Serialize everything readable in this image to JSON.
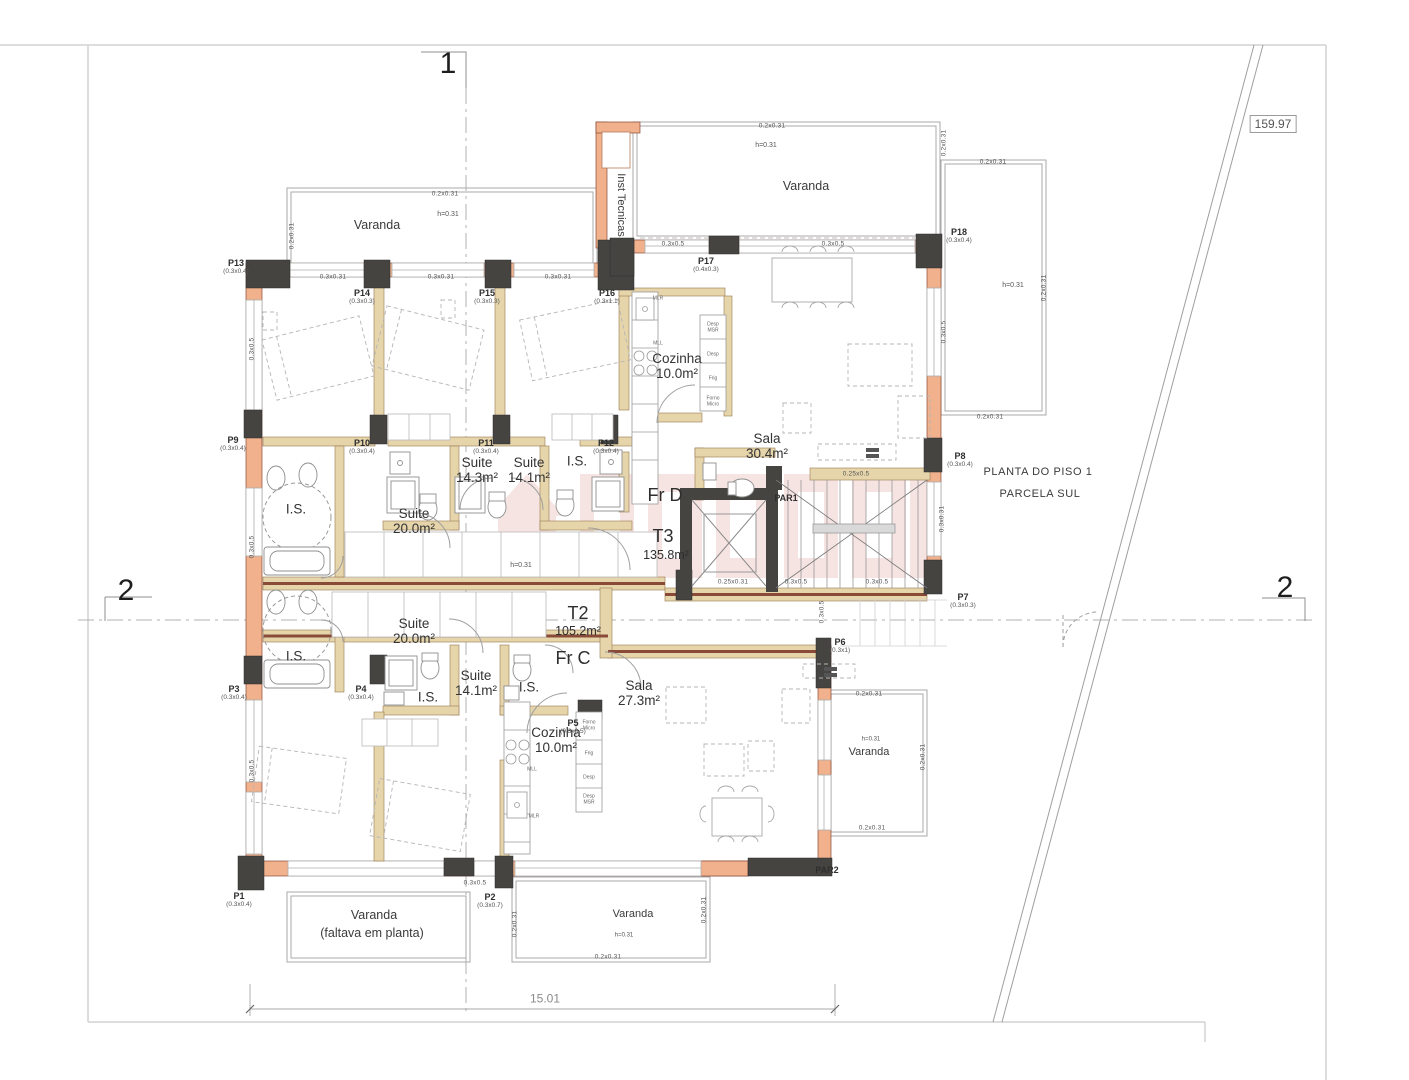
{
  "plan": {
    "colors": {
      "wall_exterior": "#f0b18c",
      "wall_interior": "#e6d5ab",
      "wall_stripe": "#8a4a38",
      "column_dark": "#454441",
      "line_gray": "#9a9a9a",
      "text": "#3b3b3b",
      "watermark": "#c44a3c"
    },
    "survey": {
      "value": "159.97",
      "x": 1273,
      "y": 124
    },
    "sections": [
      {
        "t": "1",
        "x": 448,
        "y": 64
      },
      {
        "t": "2",
        "x": 126,
        "y": 591
      },
      {
        "t": "2",
        "x": 1285,
        "y": 588
      }
    ],
    "title": [
      {
        "t": "PLANTA DO PISO 1",
        "x": 1038,
        "y": 472
      },
      {
        "t": "PARCELA SUL",
        "x": 1040,
        "y": 494
      }
    ],
    "areas": [
      {
        "t": "Varanda",
        "x": 377,
        "y": 225
      },
      {
        "t": "Varanda",
        "x": 806,
        "y": 186
      },
      {
        "t": "Inst Tecnicas",
        "x": 621,
        "y": 205,
        "r": 90,
        "s": 11
      },
      {
        "t": "Varanda",
        "x": 869,
        "y": 752,
        "s": 11
      },
      {
        "t": "Varanda",
        "x": 374,
        "y": 915
      },
      {
        "t": "(faltava em planta)",
        "x": 372,
        "y": 933
      },
      {
        "t": "Varanda",
        "x": 633,
        "y": 914,
        "s": 11
      }
    ],
    "rooms": [
      {
        "t": "Suite\n14.3m²",
        "x": 477,
        "y": 470
      },
      {
        "t": "Suite\n14.1m²",
        "x": 529,
        "y": 470
      },
      {
        "t": "I.S.",
        "x": 577,
        "y": 461
      },
      {
        "t": "Suite\n20.0m²",
        "x": 414,
        "y": 521
      },
      {
        "t": "I.S.",
        "x": 296,
        "y": 509
      },
      {
        "t": "Cozinha\n10.0m²",
        "x": 677,
        "y": 366
      },
      {
        "t": "Sala\n30.4m²",
        "x": 767,
        "y": 446
      },
      {
        "t": "Suite\n20.0m²",
        "x": 414,
        "y": 631
      },
      {
        "t": "I.S.",
        "x": 296,
        "y": 656
      },
      {
        "t": "I.S.",
        "x": 428,
        "y": 697
      },
      {
        "t": "Suite\n14.1m²",
        "x": 476,
        "y": 683
      },
      {
        "t": "I.S.",
        "x": 529,
        "y": 687
      },
      {
        "t": "Sala\n27.3m²",
        "x": 639,
        "y": 693
      },
      {
        "t": "Cozinha\n10.0m²",
        "x": 556,
        "y": 740
      }
    ],
    "units": [
      {
        "t": "Fr D",
        "x": 665,
        "y": 495,
        "s": 18
      },
      {
        "t": "T3",
        "x": 663,
        "y": 536,
        "s": 18
      },
      {
        "t": "135.8m²",
        "x": 666,
        "y": 555,
        "s": 12.5
      },
      {
        "t": "T2",
        "x": 578,
        "y": 613,
        "s": 18
      },
      {
        "t": "105.2m²",
        "x": 578,
        "y": 631,
        "s": 12.5
      },
      {
        "t": "Fr C",
        "x": 573,
        "y": 658,
        "s": 18
      }
    ],
    "doors": [
      {
        "id": "P13",
        "dim": "(0.3x0.4)",
        "x": 236,
        "y": 267
      },
      {
        "id": "P14",
        "dim": "(0.3x0.3)",
        "x": 362,
        "y": 297
      },
      {
        "id": "P15",
        "dim": "(0.3x0.3)",
        "x": 487,
        "y": 297
      },
      {
        "id": "P16",
        "dim": "(0.3x1.1)",
        "x": 607,
        "y": 297
      },
      {
        "id": "P17",
        "dim": "(0.4x0.3)",
        "x": 706,
        "y": 265
      },
      {
        "id": "P18",
        "dim": "(0.3x0.4)",
        "x": 959,
        "y": 236
      },
      {
        "id": "P9",
        "dim": "(0.3x0.4)",
        "x": 233,
        "y": 444
      },
      {
        "id": "P10",
        "dim": "(0.3x0.4)",
        "x": 362,
        "y": 447
      },
      {
        "id": "P11",
        "dim": "(0.3x0.4)",
        "x": 486,
        "y": 447
      },
      {
        "id": "P12",
        "dim": "(0.3x0.4)",
        "x": 606,
        "y": 447
      },
      {
        "id": "P8",
        "dim": "(0.3x0.4)",
        "x": 960,
        "y": 460
      },
      {
        "id": "P7",
        "dim": "(0.3x0.3)",
        "x": 963,
        "y": 601
      },
      {
        "id": "P6",
        "dim": "(0.3x1)",
        "x": 840,
        "y": 646
      },
      {
        "id": "P5",
        "dim": "(0.3x0.5)",
        "x": 573,
        "y": 727
      },
      {
        "id": "P4",
        "dim": "(0.3x0.4)",
        "x": 361,
        "y": 693
      },
      {
        "id": "P3",
        "dim": "(0.3x0.4)",
        "x": 234,
        "y": 693
      },
      {
        "id": "P2",
        "dim": "(0.3x0.7)",
        "x": 490,
        "y": 901
      },
      {
        "id": "P1",
        "dim": "(0.3x0.4)",
        "x": 239,
        "y": 900
      },
      {
        "id": "PAR1",
        "dim": "",
        "x": 786,
        "y": 498
      },
      {
        "id": "PAR2",
        "dim": "",
        "x": 827,
        "y": 870
      }
    ],
    "dims": [
      {
        "t": "0.2x0.31",
        "x": 445,
        "y": 194
      },
      {
        "t": "0.2x0.31",
        "x": 292,
        "y": 236,
        "r": -90
      },
      {
        "t": "0.3x0.31",
        "x": 333,
        "y": 277
      },
      {
        "t": "0.3x0.31",
        "x": 441,
        "y": 277
      },
      {
        "t": "0.3x0.31",
        "x": 558,
        "y": 277
      },
      {
        "t": "0.2x0.31",
        "x": 772,
        "y": 126
      },
      {
        "t": "0.2x0.31",
        "x": 944,
        "y": 143,
        "r": -90
      },
      {
        "t": "0.2x0.31",
        "x": 993,
        "y": 162
      },
      {
        "t": "0.3x0.5",
        "x": 673,
        "y": 244
      },
      {
        "t": "0.3x0.5",
        "x": 833,
        "y": 244
      },
      {
        "t": "0.2x0.31",
        "x": 1044,
        "y": 288,
        "r": -90
      },
      {
        "t": "0.3x0.5",
        "x": 944,
        "y": 332,
        "r": -90
      },
      {
        "t": "0.2x0.31",
        "x": 990,
        "y": 417
      },
      {
        "t": "0.3x0.5",
        "x": 252,
        "y": 349,
        "r": -90
      },
      {
        "t": "0.3x0.5",
        "x": 252,
        "y": 547,
        "r": -90
      },
      {
        "t": "0.3x0.5",
        "x": 252,
        "y": 771,
        "r": -90
      },
      {
        "t": "0.25x0.5",
        "x": 856,
        "y": 474
      },
      {
        "t": "0.3x0.31",
        "x": 942,
        "y": 519,
        "r": -90
      },
      {
        "t": "0.25x0.31",
        "x": 733,
        "y": 582
      },
      {
        "t": "0.3x0.5",
        "x": 796,
        "y": 582
      },
      {
        "t": "0.3x0.5",
        "x": 877,
        "y": 582
      },
      {
        "t": "0.3x0.5",
        "x": 822,
        "y": 612,
        "r": -90
      },
      {
        "t": "0.2x0.31",
        "x": 869,
        "y": 694
      },
      {
        "t": "0.2x0.31",
        "x": 923,
        "y": 757,
        "r": -90
      },
      {
        "t": "0.2x0.31",
        "x": 872,
        "y": 828
      },
      {
        "t": "0.2x0.31",
        "x": 704,
        "y": 910,
        "r": -90
      },
      {
        "t": "0.2x0.31",
        "x": 608,
        "y": 957
      },
      {
        "t": "0.2x0.31",
        "x": 515,
        "y": 924,
        "r": -90
      },
      {
        "t": "0.3x0.5",
        "x": 475,
        "y": 883
      }
    ],
    "heights": [
      {
        "t": "h=0.31",
        "x": 448,
        "y": 215
      },
      {
        "t": "h=0.31",
        "x": 766,
        "y": 146
      },
      {
        "t": "h=0.31",
        "x": 1013,
        "y": 286
      },
      {
        "t": "h=0.31",
        "x": 521,
        "y": 566
      },
      {
        "t": "h=0.31",
        "x": 871,
        "y": 740,
        "s": 6
      },
      {
        "t": "h=0.31",
        "x": 624,
        "y": 936,
        "s": 6
      }
    ],
    "appliances": [
      {
        "t": "MLR",
        "x": 658,
        "y": 299
      },
      {
        "t": "MLL",
        "x": 658,
        "y": 344
      },
      {
        "t": "Desp\nMSR",
        "x": 713,
        "y": 328
      },
      {
        "t": "Desp",
        "x": 713,
        "y": 355
      },
      {
        "t": "Frig",
        "x": 713,
        "y": 379
      },
      {
        "t": "Forno\nMicro",
        "x": 713,
        "y": 402
      },
      {
        "t": "Forno\nMicro",
        "x": 589,
        "y": 726
      },
      {
        "t": "Frig",
        "x": 589,
        "y": 754
      },
      {
        "t": "Desp",
        "x": 589,
        "y": 778
      },
      {
        "t": "Desp\nMSR",
        "x": 589,
        "y": 800
      },
      {
        "t": "MLL",
        "x": 532,
        "y": 770
      },
      {
        "t": "MLR",
        "x": 534,
        "y": 817
      }
    ],
    "total_dim": {
      "t": "15.01",
      "x": 545,
      "y": 999
    }
  }
}
